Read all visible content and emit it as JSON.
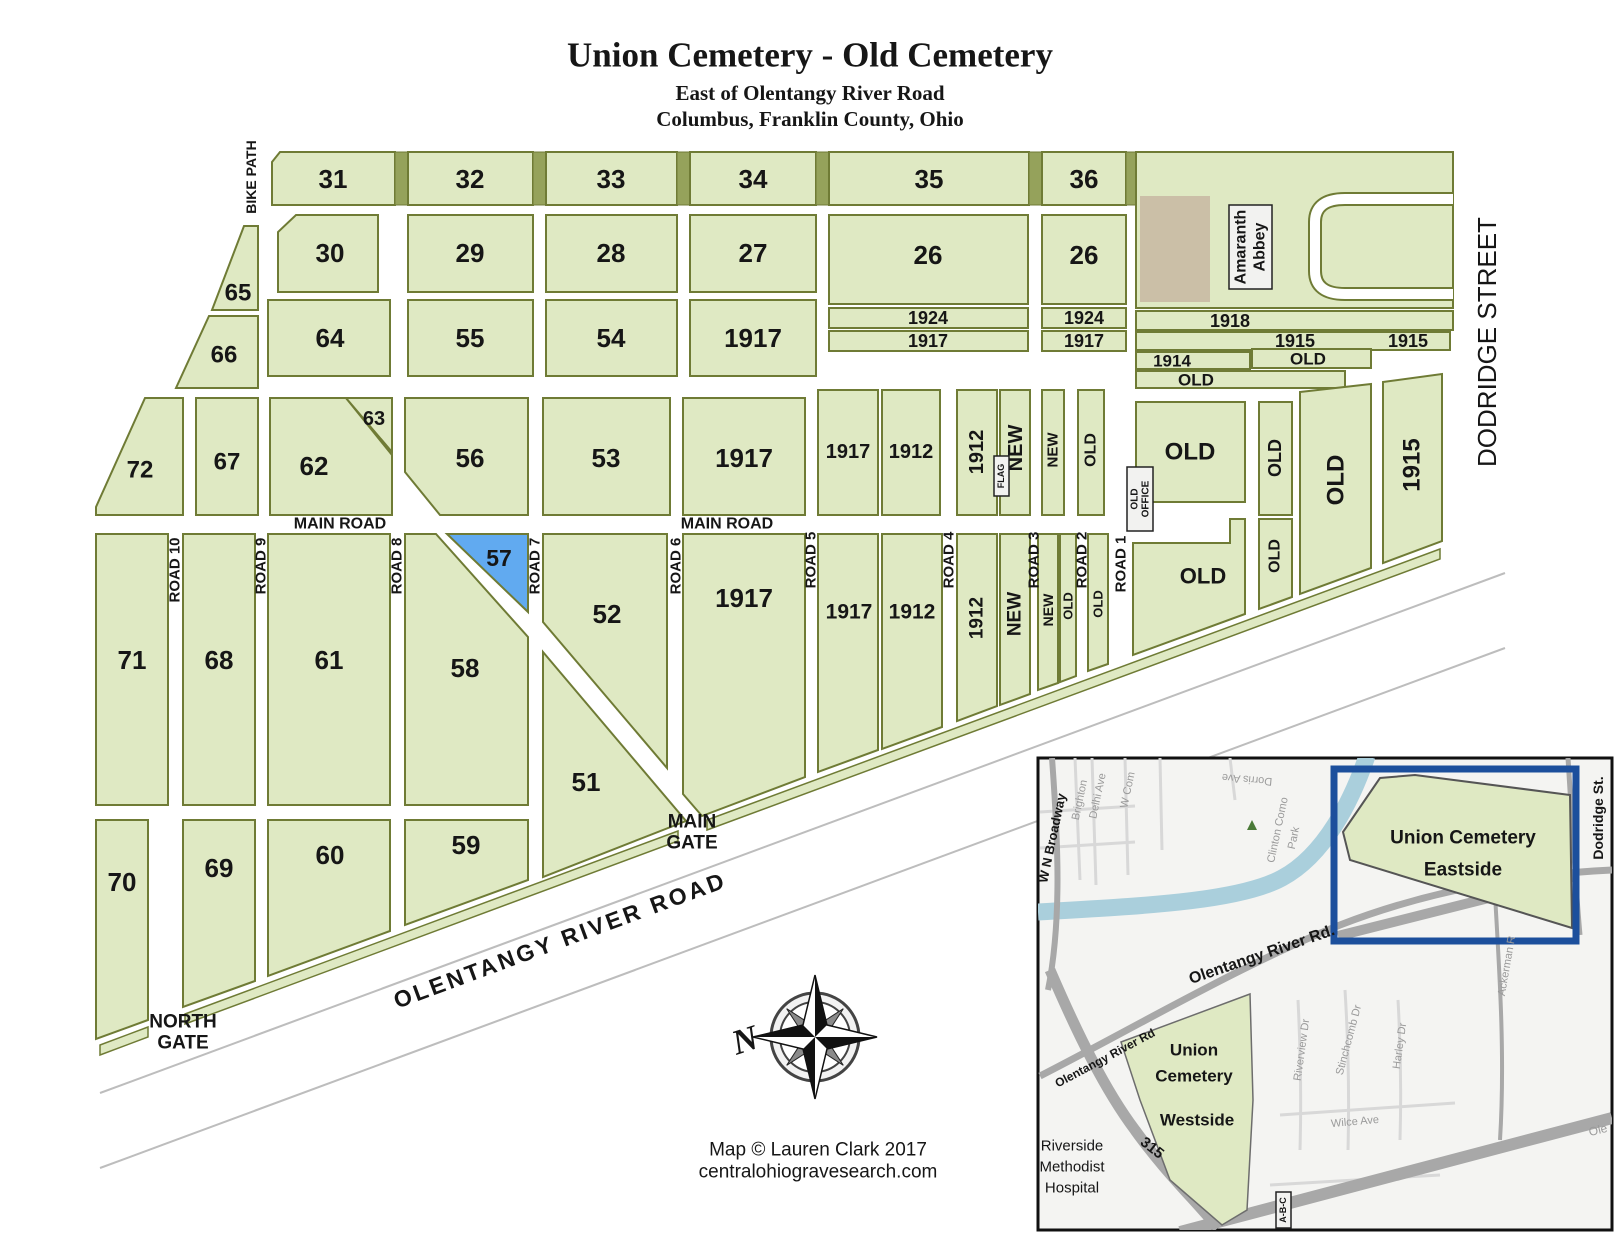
{
  "title": {
    "main": "Union Cemetery - Old Cemetery",
    "sub1": "East of Olentangy River Road",
    "sub2": "Columbus, Franklin County, Ohio"
  },
  "colors": {
    "section_fill": "#dfe9c3",
    "section_border": "#6f7b35",
    "separator": "#95a25b",
    "highlight_section": "#61aaf0",
    "building": "#cbbfa7",
    "inset_highlight_border": "#1c4f9c",
    "river": "#aacfdc"
  },
  "map": {
    "sections": {
      "s31": "31",
      "s32": "32",
      "s33": "33",
      "s34": "34",
      "s35": "35",
      "s36": "36",
      "s30": "30",
      "s29": "29",
      "s28": "28",
      "s27": "27",
      "s26a": "26",
      "s26b": "26",
      "s65": "65",
      "s66": "66",
      "s64": "64",
      "s55": "55",
      "s54": "54",
      "s1917a": "1917",
      "s72": "72",
      "s67": "67",
      "s62": "62",
      "s63": "63",
      "s56": "56",
      "s53": "53",
      "s1917b": "1917",
      "s71": "71",
      "s68": "68",
      "s61": "61",
      "s58": "58",
      "s57": "57",
      "s52": "52",
      "s51": "51",
      "s70": "70",
      "s69": "69",
      "s60": "60",
      "s59": "59",
      "s1917c": "1917",
      "s1912a": "1912",
      "s1912b": "1912",
      "sNewA": "NEW",
      "sNewB": "NEW",
      "sOldA": "OLD",
      "sBigOld": "OLD",
      "s1917d": "1917",
      "s1917e": "1917",
      "s1912c": "1912",
      "s1912d": "1912",
      "sNewC": "NEW",
      "sNewD": "NEW",
      "sOldB": "OLD",
      "sOldC": "OLD",
      "sLowerOld": "OLD",
      "sOldStripC1": "OLD",
      "sOldStripC2": "OLD",
      "sOldD": "OLD",
      "s1915e": "1915"
    },
    "strips": {
      "s1924L": "1924",
      "s1917Ls": "1917",
      "s1924R": "1924",
      "s1917Rs": "1917",
      "s1918": "1918",
      "s1915a": "1915",
      "s1915b": "1915",
      "s1914": "1914",
      "sOldStA": "OLD",
      "sOldStB": "OLD"
    },
    "roads": {
      "r1": "ROAD 1",
      "r2": "ROAD 2",
      "r3": "ROAD 3",
      "r4": "ROAD 4",
      "r5": "ROAD 5",
      "r6": "ROAD 6",
      "r7": "ROAD 7",
      "r8": "ROAD 8",
      "r9": "ROAD 9",
      "r10": "ROAD 10",
      "mainRoadL": "MAIN ROAD",
      "mainRoadR": "MAIN ROAD",
      "bikePath": "BIKE PATH",
      "dodridge": "DODRIDGE STREET",
      "olentangy": "OLENTANGY RIVER ROAD"
    },
    "gates": {
      "north1": "NORTH",
      "north2": "GATE",
      "main1": "MAIN",
      "main2": "GATE"
    },
    "abbey": {
      "l1": "Amaranth",
      "l2": "Abbey"
    },
    "office": {
      "l1": "OLD",
      "l2": "OFFICE"
    },
    "flag": "FLAG",
    "compassN": "N",
    "credit": {
      "l1": "Map © Lauren Clark 2017",
      "l2": "centralohiogravesearch.com"
    }
  },
  "inset": {
    "eastside": {
      "l1": "Union Cemetery",
      "l2": "Eastside"
    },
    "westside": {
      "l1": "Union",
      "l2": "Cemetery",
      "l3": "Westside"
    },
    "hospital": {
      "l1": "Riverside",
      "l2": "Methodist",
      "l3": "Hospital"
    },
    "streets": {
      "broadway": "W N Broadway",
      "brighton": "Brighton",
      "delhi": "Delhi Ave",
      "wcom": "W Com",
      "dorris": "Dorris Ave",
      "clinton1": "Clinton Como",
      "clinton2": "Park",
      "olentangyRd": "Olentangy River Rd.",
      "olentangyRd2": "Olentangy River Rd",
      "dodridgeSt": "Dodridge St.",
      "ackerman": "Ackerman R",
      "riverview": "Riverview Dr",
      "stinchcomb": "Stinchcomb Dr",
      "harley": "Harley Dr",
      "wilce": "Wilce Ave",
      "i315": "315",
      "abc": "A-B-C",
      "ole": "Ole"
    }
  }
}
